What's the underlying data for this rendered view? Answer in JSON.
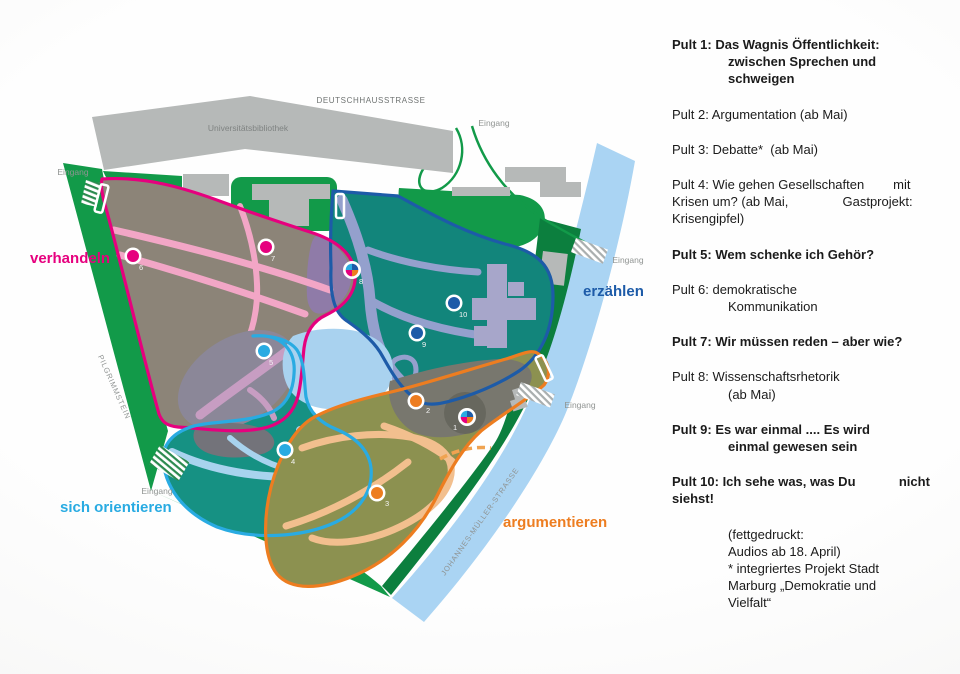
{
  "map": {
    "entrance_label": "Eingang",
    "street_labels": {
      "top": "DEUTSCHHAUSSTRASSE",
      "left": "PILGRIMMSTEIN",
      "bottom": "JOHANNES-MÜLLER-STRASSE"
    },
    "building_labels": {
      "library": "Universitätsbibliothek"
    },
    "zones": [
      {
        "id": "verhandeln",
        "label": "verhandeln",
        "color": "#e6007e",
        "fill": "#8c8478"
      },
      {
        "id": "erzaehlen",
        "label": "erzählen",
        "color": "#1d5ba8",
        "fill": "#12857b"
      },
      {
        "id": "sich-orientieren",
        "label": "sich orientieren",
        "color": "#29abe2",
        "fill": "#169183"
      },
      {
        "id": "argumentieren",
        "label": "argumentieren",
        "color": "#ed7d20",
        "fill": "#8c9150"
      }
    ],
    "markers": [
      {
        "n": "1",
        "type": "pie"
      },
      {
        "n": "2",
        "color": "#ed7d20"
      },
      {
        "n": "3",
        "color": "#ed7d20"
      },
      {
        "n": "4",
        "color": "#29abe2"
      },
      {
        "n": "5",
        "color": "#29abe2"
      },
      {
        "n": "6",
        "color": "#e6007e"
      },
      {
        "n": "7",
        "color": "#e6007e"
      },
      {
        "n": "8",
        "type": "pie"
      },
      {
        "n": "9",
        "color": "#1d5ba8"
      },
      {
        "n": "10",
        "color": "#1d5ba8"
      }
    ],
    "pie_colors": [
      "#1d5ba8",
      "#ed7d20",
      "#e6007e",
      "#29abe2"
    ],
    "palette": {
      "park_green": "#129a49",
      "dark_green": "#0c7f3e",
      "river": "#aad4f3",
      "pond": "#a9d2ef",
      "building_gray": "#b6b9b8",
      "building_lavender": "#a7a6ca"
    }
  },
  "legend": {
    "items": [
      {
        "bold": true,
        "indent_cont": true,
        "lines": [
          "Pult 1: Das Wagnis Öffentlichkeit:",
          "zwischen Sprechen und",
          "schweigen"
        ]
      },
      {
        "bold": false,
        "indent_cont": false,
        "lines": [
          "Pult 2: Argumentation (ab Mai)"
        ]
      },
      {
        "bold": false,
        "indent_cont": false,
        "lines": [
          "Pult 3: Debatte*  (ab Mai)"
        ]
      },
      {
        "bold": false,
        "indent_cont": false,
        "lines": [
          "Pult 4: Wie gehen Gesellschaften        mit",
          "Krisen um? (ab Mai,               Gastprojekt:",
          "Krisengipfel)"
        ]
      },
      {
        "bold": true,
        "indent_cont": false,
        "lines": [
          "Pult 5: Wem schenke ich Gehör?"
        ]
      },
      {
        "bold": false,
        "indent_cont": true,
        "lines": [
          "Pult 6: demokratische",
          "Kommunikation"
        ]
      },
      {
        "bold": true,
        "indent_cont": false,
        "lines": [
          "Pult 7: Wir müssen reden – aber wie?"
        ]
      },
      {
        "bold": false,
        "indent_cont": true,
        "lines": [
          "Pult 8: Wissenschaftsrhetorik",
          "(ab Mai)"
        ]
      },
      {
        "bold": true,
        "indent_cont": true,
        "lines": [
          "Pult 9: Es war einmal .... Es wird",
          "einmal gewesen sein"
        ]
      },
      {
        "bold": true,
        "indent_cont": false,
        "lines": [
          "Pult 10: Ich sehe was, was Du            nicht",
          "siehst!"
        ]
      }
    ],
    "footnote_lines": [
      "(fettgedruckt:",
      "Audios ab 18. April)",
      "* integriertes Projekt Stadt",
      "Marburg „Demokratie und",
      "Vielfalt“"
    ]
  }
}
